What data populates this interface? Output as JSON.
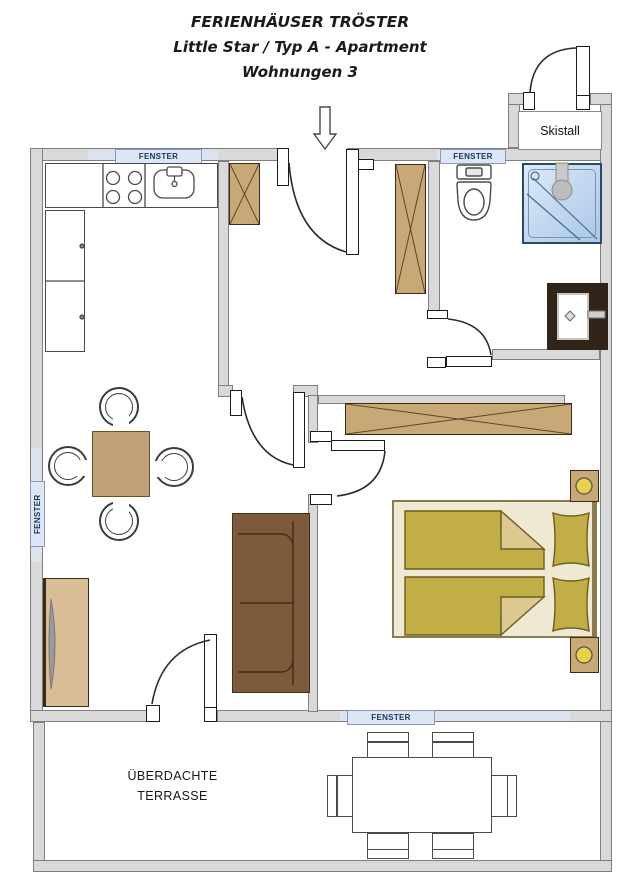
{
  "title": {
    "line1": "FERIENHÄUSER TRÖSTER",
    "line2": "Little Star / Typ A - Apartment",
    "line3": "Wohnungen 3"
  },
  "skistall": {
    "label": "Skistall"
  },
  "terrace": {
    "label_line1": "ÜBERDACHTE",
    "label_line2": "TERRASSE"
  },
  "windows": {
    "top_left": "FENSTER",
    "top_right": "FENSTER",
    "left": "FENSTER",
    "bottom": "FENSTER"
  },
  "colors": {
    "wall": "#d9d9d9",
    "wall_border": "#7f7f7f",
    "window_fill": "#dce6f5",
    "window_border": "#8a9ab8",
    "window_text": "#17365d",
    "wood": "#c9a878",
    "wood_border": "#3a2a16",
    "wood_line": "#5d4526",
    "sofa": "#7d5a3b",
    "sofa_border": "#42301c",
    "table_wood": "#c2a176",
    "sideboard": "#d8bd96",
    "bed_base": "#efe8d2",
    "bed_border": "#8a7a50",
    "linen": "#c2ae47",
    "linen_border": "#6b5e20",
    "linen_fold": "#dcc98f",
    "lamp": "#e7d14b",
    "shower_a": "#ddeafa",
    "shower_b": "#a9c7e6",
    "vanity": "#33241a",
    "fixture_line": "#4a4a4a",
    "ink": "#1a1a1a"
  }
}
